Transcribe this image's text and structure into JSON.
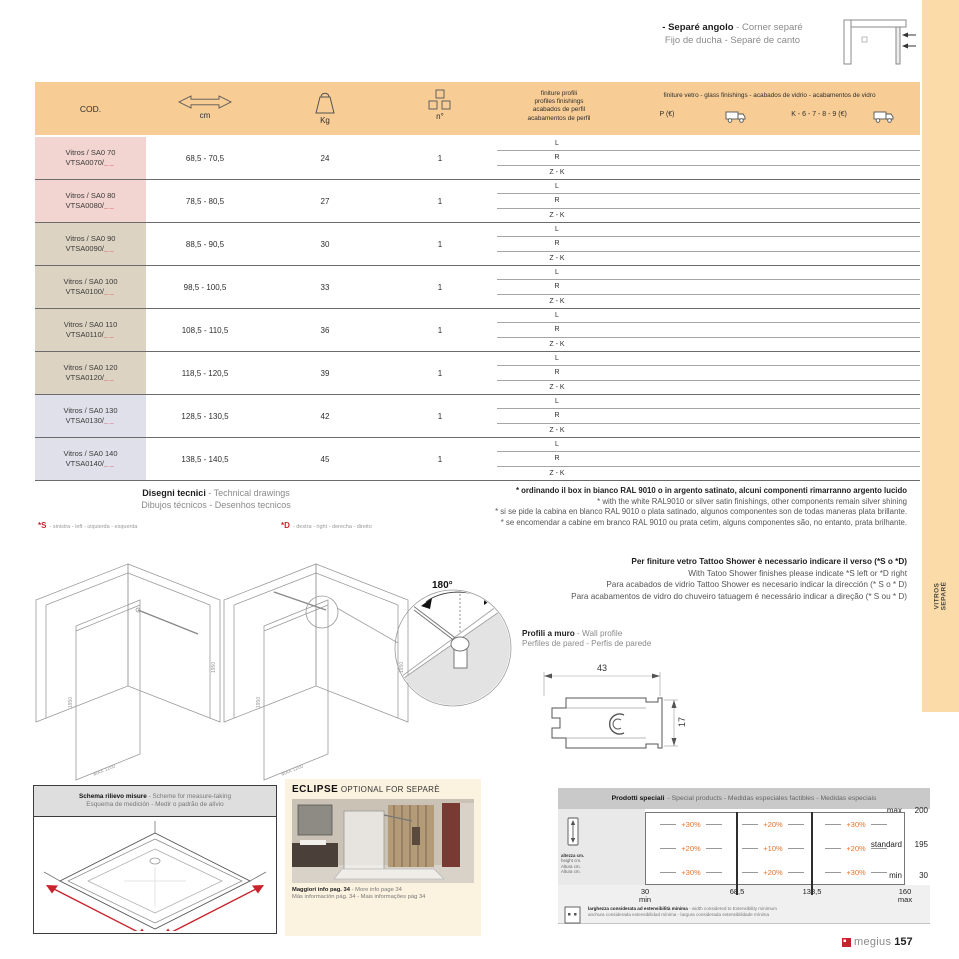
{
  "corner_note": {
    "line1_bold": "- Separé angolo",
    "line1_rest": " - Corner separé",
    "line2": "Fijo de ducha - Separé de canto"
  },
  "side_tab": {
    "line1": "VITROS",
    "line2": "SEPARÈ"
  },
  "table": {
    "header": {
      "cod": "COD.",
      "cm": "cm",
      "kg": "Kg",
      "n": "n°",
      "profiles_lines": [
        "finiture profili",
        "profiles finishings",
        "acabados de perfil",
        "acabamentos de perfil"
      ],
      "glass_line": "finiture vetro - glass finishings - acabados de vidrio - acabamentos de vidro",
      "p_label": "P (€)",
      "k_label": "K - 6 - 7 - 8 - 9 (€)"
    },
    "finish_options": [
      "L",
      "R",
      "Z - K"
    ],
    "rows": [
      {
        "name": "Vitros / SA0 70",
        "code": "VTSA0070/",
        "blank": "__",
        "cm": "68,5 - 70,5",
        "kg": "24",
        "n": "1"
      },
      {
        "name": "Vitros / SA0 80",
        "code": "VTSA0080/",
        "blank": "__",
        "cm": "78,5 - 80,5",
        "kg": "27",
        "n": "1"
      },
      {
        "name": "Vitros / SA0 90",
        "code": "VTSA0090/",
        "blank": "__",
        "cm": "88,5 - 90,5",
        "kg": "30",
        "n": "1"
      },
      {
        "name": "Vitros / SA0 100",
        "code": "VTSA0100/",
        "blank": "__",
        "cm": "98,5 - 100,5",
        "kg": "33",
        "n": "1"
      },
      {
        "name": "Vitros / SA0 110",
        "code": "VTSA0110/",
        "blank": "__",
        "cm": "108,5 - 110,5",
        "kg": "36",
        "n": "1"
      },
      {
        "name": "Vitros / SA0 120",
        "code": "VTSA0120/",
        "blank": "__",
        "cm": "118,5 - 120,5",
        "kg": "39",
        "n": "1"
      },
      {
        "name": "Vitros / SA0 130",
        "code": "VTSA0130/",
        "blank": "__",
        "cm": "128,5 - 130,5",
        "kg": "42",
        "n": "1"
      },
      {
        "name": "Vitros / SA0 140",
        "code": "VTSA0140/",
        "blank": "__",
        "cm": "138,5 - 140,5",
        "kg": "45",
        "n": "1"
      }
    ]
  },
  "drawings": {
    "title_bold": "Disegni tecnici",
    "title_rest": " - Technical drawings",
    "subtitle": "Dibujos técnicos - Desenhos tecnicos",
    "left_mark": "*S",
    "left_text": "- sinistra - left - izquierda - esquerda",
    "right_mark": "*D",
    "right_text": "- destra - right - derecha - direito",
    "dim_label_h": "1950",
    "dim_label_w": "MAX 1200",
    "angle": "180°"
  },
  "ral_note": {
    "line1": "* ordinando il box in bianco RAL 9010 o in argento satinato, alcuni componenti rimarranno argento lucido",
    "line2": "* with the white RAL9010 or silver satin finishings, other components remain silver shining",
    "line3": "* si se pide la cabina en blanco RAL 9010 o plata satinado, algunos componentes son de todas maneras plata brillante.",
    "line4": "* se encomendar a cabine em branco RAL 9010 ou prata cetim, alguns componentes são, no entanto, prata brilhante."
  },
  "tattoo_note": {
    "line1": "Per finiture vetro Tattoo Shower è necessario indicare il verso (*S o *D)",
    "line2": "With Tatoo Shower finishes please indicate *S left or *D right",
    "line3": "Para acabados de vidrio Tattoo Shower es necesario indicar la dirección (* S o * D)",
    "line4": "Para acabamentos de vidro do chuveiro tatuagem é necessário indicar a direção (* S ou * D)"
  },
  "wall_profile": {
    "title_bold": "Profili a muro",
    "title_rest": " - Wall profile",
    "subtitle": "Perfiles de pared - Perfis de parede",
    "dim_width": "43",
    "dim_height": "17"
  },
  "schema": {
    "title_bold": "Schema rilievo misure",
    "title_rest": " - Scheme for measure-taking",
    "subtitle": "Esquema de medición - Medir o padrão de alívio"
  },
  "eclipse": {
    "title_bold": "ECLIPSE",
    "title_rest": " OPTIONAL FOR SEPARÈ",
    "caption_bold": "Maggiori info pag. 34",
    "caption_rest": " - More info page 34",
    "caption2": "Más información pág. 34 - Mais informações pág 34"
  },
  "special": {
    "title_bold": "Prodotti speciali",
    "title_rest": "- Special products - Medidas especiales factibles - Medidas especiais",
    "height_labels": [
      "altezza cm.",
      "height cm.",
      "Altura cm.",
      "Altura cm."
    ],
    "rows": [
      {
        "label": "max",
        "value": "200"
      },
      {
        "label": "standard",
        "value": "195"
      },
      {
        "label": "min",
        "value": "30"
      }
    ],
    "grid": [
      [
        "+30%",
        "+20%",
        "+30%"
      ],
      [
        "+20%",
        "+10%",
        "+20%"
      ],
      [
        "+30%",
        "+20%",
        "+30%"
      ]
    ],
    "axis": [
      {
        "v": "30",
        "s": "min"
      },
      {
        "v": "68,5",
        "s": ""
      },
      {
        "v": "138,5",
        "s": ""
      },
      {
        "v": "160",
        "s": "max"
      }
    ],
    "note_bold": "larghezza considerata ad estensibilità minima",
    "note_rest": " - width considered to Extensibility minimum",
    "note2": "anchura considerada extensibilidad mínima - largura considerada extensibilidade mínima"
  },
  "footer": {
    "brand": "megius",
    "page": "157"
  },
  "colors": {
    "header_orange": "#F7CD95",
    "band_orange": "#FBDCA9",
    "row_pink": "#F2D4D0",
    "row_tan": "#DCD3C2",
    "row_lavender": "#E0E0EA",
    "percent_orange": "#E8732A",
    "accent_red": "#C8232C"
  }
}
